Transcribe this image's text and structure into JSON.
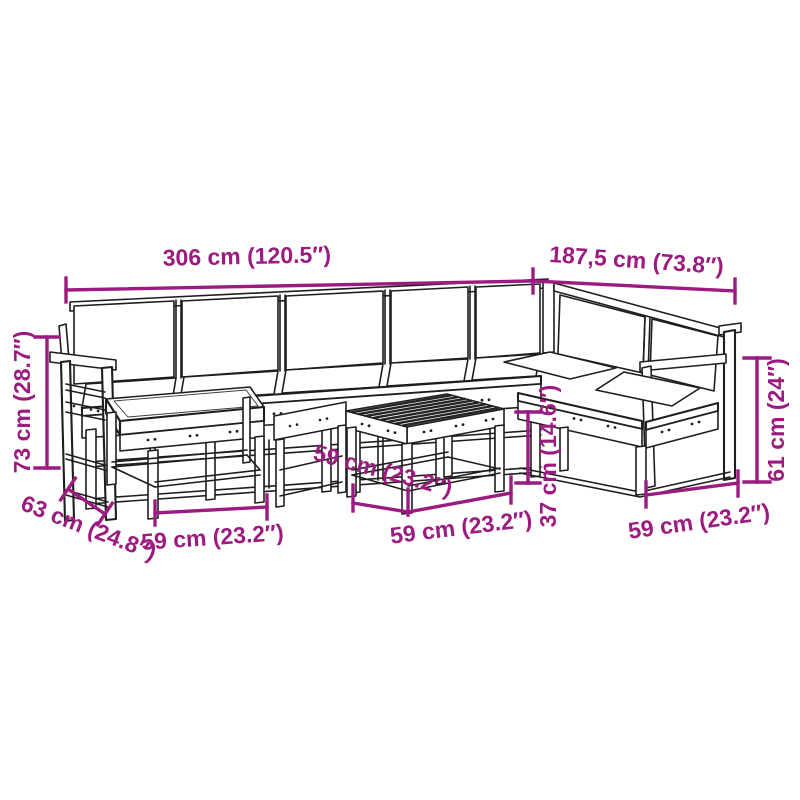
{
  "figure": {
    "description": "Dimension diagram line drawing of an L-shaped wooden garden lounge set with corner sofa modules, footstools and a slatted coffee table",
    "accent_color": "#9B1B80",
    "line_color": "#1e1e1e",
    "background": "#ffffff"
  },
  "dimensions": {
    "total_width": "306 cm (120.5″)",
    "right_depth": "187,5 cm (73.8″)",
    "back_height": "73 cm (28.7″)",
    "left_seat_depth": "63 cm (24.8″)",
    "left_stool_width": "59 cm (23.2″)",
    "table_depth": "59 cm (23.2″)",
    "table_width": "59 cm (23.2″)",
    "table_height": "37 cm (14.6″)",
    "arm_height": "61 cm (24″)",
    "right_seat_width": "59 cm (23.2″)"
  }
}
